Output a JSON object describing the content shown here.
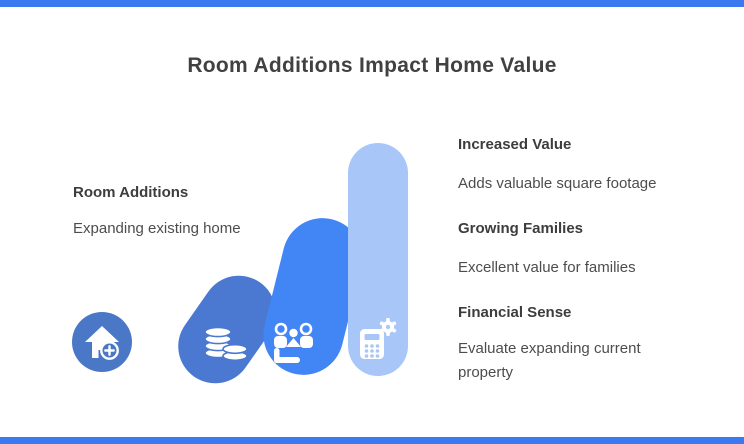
{
  "title": "Room Additions Impact Home Value",
  "accent": {
    "bar_color": "#3b79f1"
  },
  "left_block": {
    "heading": "Room Additions",
    "description": "Expanding existing home"
  },
  "badge": {
    "icon": "house-plus-icon",
    "color": "#4a78c6"
  },
  "bars": [
    {
      "icon": "coins-icon",
      "color": "#4b79d1",
      "height_rank": 1,
      "tilt_deg": 35
    },
    {
      "icon": "family-icon",
      "color": "#4285f4",
      "height_rank": 2,
      "tilt_deg": 14
    },
    {
      "icon": "calculator-gear-icon",
      "color": "#a8c7f8",
      "height_rank": 3,
      "tilt_deg": 0
    }
  ],
  "right_blocks": [
    {
      "heading": "Increased Value",
      "description": "Adds valuable square footage"
    },
    {
      "heading": "Growing Families",
      "description": "Excellent value for families"
    },
    {
      "heading": "Financial Sense",
      "description": "Evaluate expanding current property"
    }
  ]
}
